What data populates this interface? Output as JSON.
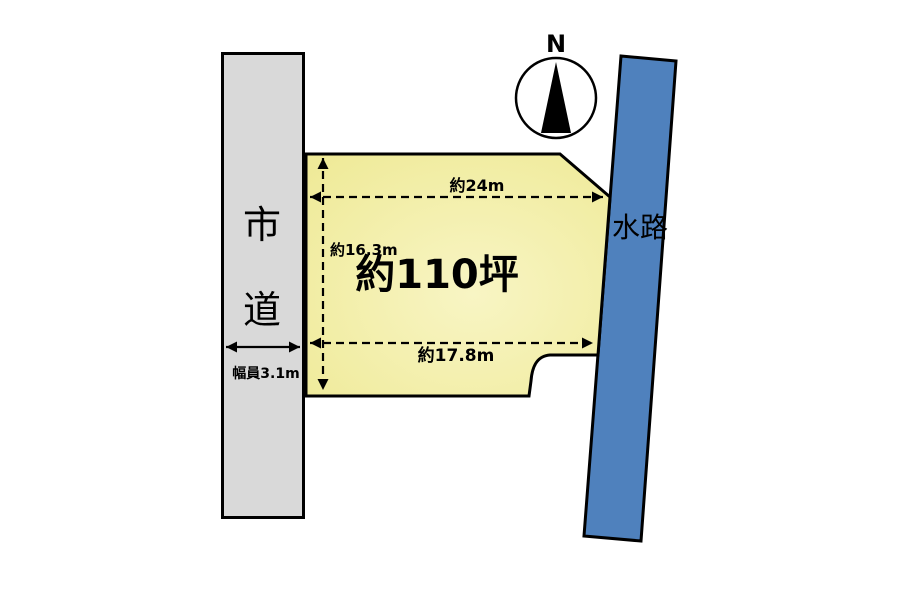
{
  "diagram_type": "land-plot-site-plan",
  "colors": {
    "background": "#FFFFFF",
    "road_fill": "#D9D9D9",
    "waterway_fill": "#4F81BD",
    "plot_fill_center": "#F8F5C4",
    "plot_fill_edge": "#EFEA98",
    "outline": "#000000"
  },
  "compass": {
    "north_label": "N"
  },
  "road": {
    "label_chars": [
      "市",
      "道"
    ],
    "width_label": "幅員3.1m"
  },
  "waterway": {
    "label": "水路"
  },
  "plot": {
    "area_label": "約110坪",
    "dim_top": "約24m",
    "dim_left": "約16.3m",
    "dim_bottom": "約17.8m"
  }
}
